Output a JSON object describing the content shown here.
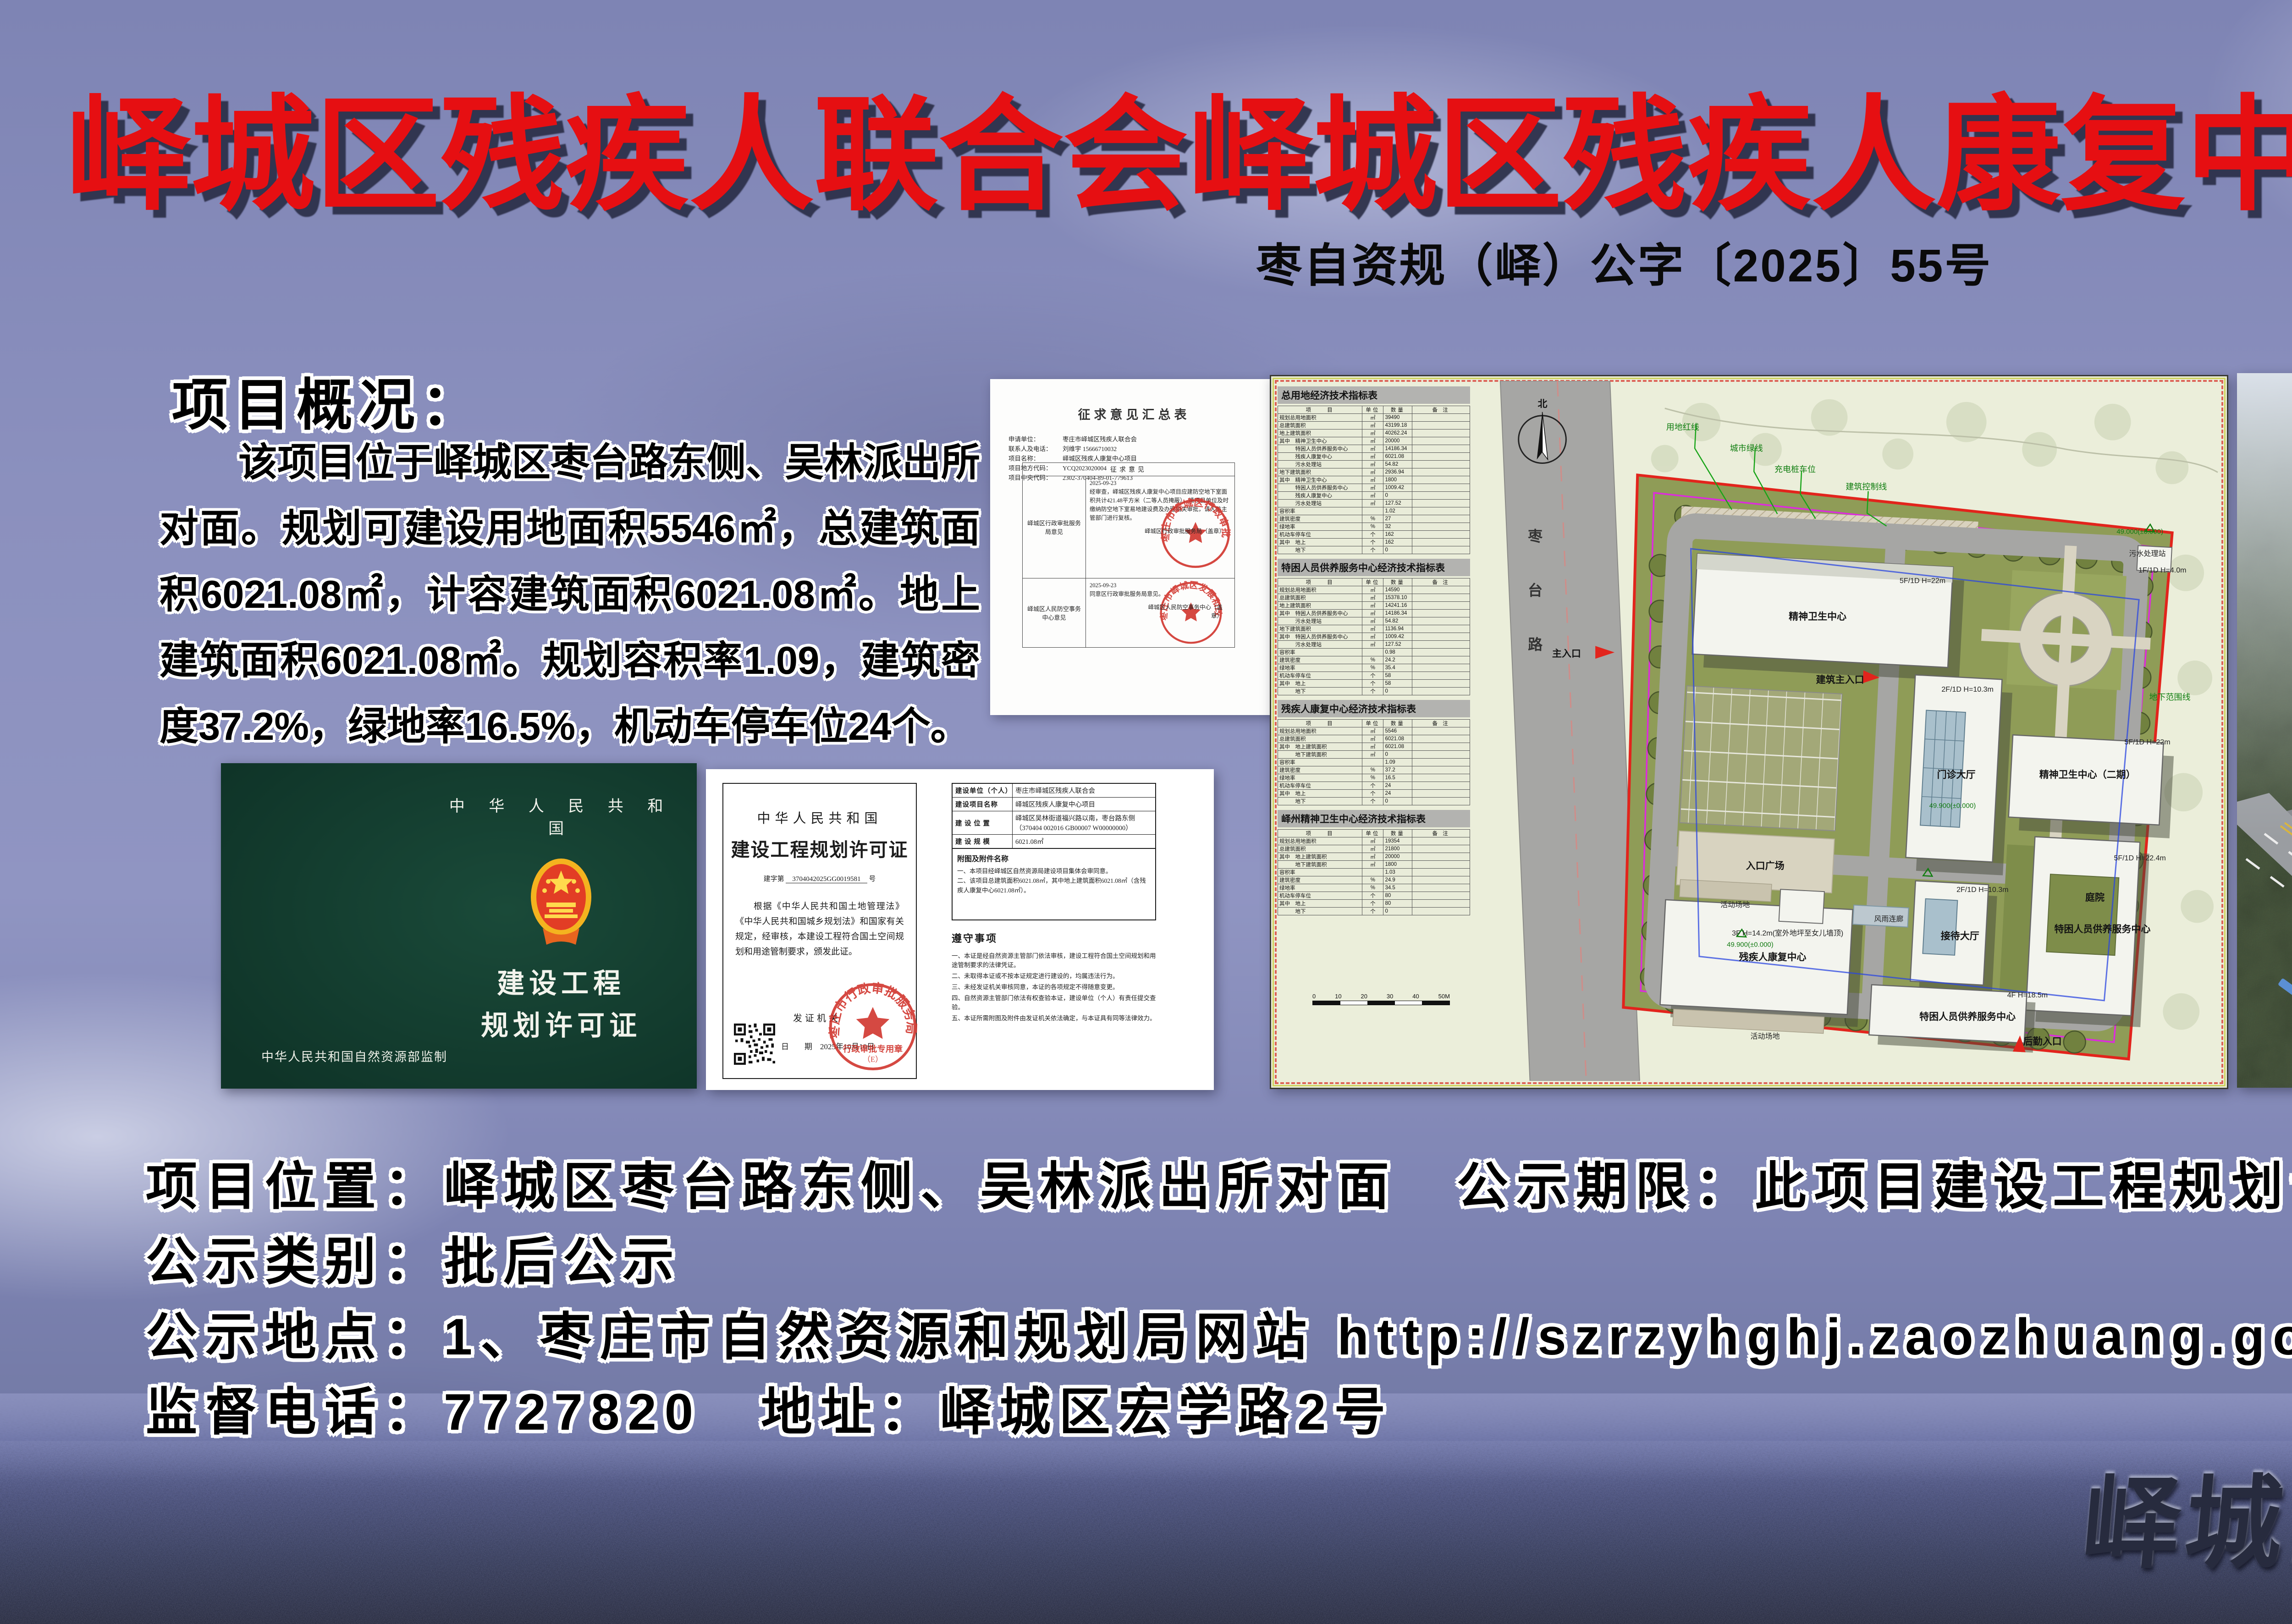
{
  "poster": {
    "title": "峄城区残疾人联合会峄城区残疾人康复中心项目批后公示",
    "doc_number": "枣自资规（峄）公字〔2025〕55号",
    "overview": {
      "heading": "项目概况：",
      "body": "该项目位于峄城区枣台路东侧、吴林派出所对面。规划可建设用地面积5546㎡，总建筑面积6021.08㎡，计容建筑面积6021.08㎡。地上建筑面积6021.08㎡。规划容积率1.09，建筑密度37.2%，绿地率16.5%，机动车停车位24个。"
    },
    "footer": {
      "line1": {
        "label1": "项目位置：",
        "value1": "峄城区枣台路东侧、吴林派出所对面",
        "label2": "公示期限：",
        "value2": "此项目建设工程规划许可证生效日至竣工验收合格日"
      },
      "line2": {
        "label1": "公示类别：",
        "value1": "批后公示"
      },
      "line3": {
        "label1": "公示地点：",
        "value1": "1、枣庄市自然资源和规划局网站 http://szrzyhghj.zaozhuang.gov.cn/",
        "value2": "2、建设项目现场"
      },
      "line4": {
        "label1": "监督电话：",
        "value1": "7727820",
        "label2": "地址：",
        "value2": "峄城区宏学路2号"
      }
    },
    "watermark": "峄城区自然资源局监制"
  },
  "opinion_doc": {
    "title": "征求意见汇总表",
    "fields": [
      {
        "label": "申请单位：",
        "value": "枣庄市峄城区残疾人联合会"
      },
      {
        "label": "联系人及电话：",
        "value": "刘维宇  15666710032"
      },
      {
        "label": "项目名称：",
        "value": "峄城区残疾人康复中心项目"
      },
      {
        "label": "项目地方代码：",
        "value": "YCQ2023020004"
      },
      {
        "label": "项目中央代码：",
        "value": "2302-370404-89-01-779613"
      }
    ],
    "table_header": "征求意见",
    "row1": {
      "org": "峄城区行政审批服务局意见",
      "date": "2025-09-23",
      "text": "经审查，峄城区残疾人康复中心项目应建防空地下室面积共计421.48平方米（二等人员掩蔽），请项目单位及时缴纳防空地下室易地建设费及办理相关审批，请人防主管部门进行复核。",
      "sign": "峄城区行政审批服务局（盖章）",
      "stamp_arc": "枣庄市峄城区行政审批服务局"
    },
    "row2": {
      "org": "峄城区人民防空事务中心意见",
      "date": "2025-09-23",
      "text": "同意区行政审批服务局意见。",
      "sign": "峄城区人民防空事务中心（盖章）",
      "stamp_arc": "枣庄市峄城区发展和改革局"
    }
  },
  "green_cert": {
    "country": "中 华 人 民 共 和 国",
    "title_line1": "建设工程",
    "title_line2": "规划许可证",
    "footer": "中华人民共和国自然资源部监制"
  },
  "white_cert": {
    "left": {
      "country": "中华人民共和国",
      "title": "建设工程规划许可证",
      "number_prefix": "建字第",
      "number": "3704042025GG0019581",
      "number_suffix": "号",
      "body": "根据《中华人民共和国土地管理法》《中华人民共和国城乡规划法》和国家有关规定，经审核，本建设工程符合国土空间规划和用途管制要求，颁发此证。",
      "issuer_label": "发证机关",
      "date_label": "日　　期",
      "date": "2025年10月10日",
      "stamp_arc": "枣庄市行政审批服务局",
      "stamp_line": "行政审批专用章",
      "stamp_sub": "（E）"
    },
    "right": {
      "rows": [
        {
          "label": "建设单位（个人）",
          "value": "枣庄市峄城区残疾人联合会"
        },
        {
          "label": "建设项目名称",
          "value": "峄城区残疾人康复中心项目"
        },
        {
          "label": "建 设 位 置",
          "value": "峄城区吴林街道福兴路以南，枣台路东侧（370404 002016 GB00007 W00000000）"
        },
        {
          "label": "建 设 规 模",
          "value": "6021.08㎡"
        }
      ],
      "attach_heading": "附图及附件名称",
      "attach_items": [
        {
          "text": "一、本项目经峄城区自然资源局建设项目集体会审同意。"
        },
        {
          "text": "二、该项目总建筑面积6021.08㎡，其中地上建筑面积6021.08㎡（含残疾人康复中心6021.08㎡）。"
        }
      ],
      "rules_heading": "遵守事项",
      "rules": [
        {
          "text": "一、本证是经自然资源主管部门依法审核，建设工程符合国土空间规划和用途管制要求的法律凭证。"
        },
        {
          "text": "二、未取得本证或不按本证规定进行建设的，均属违法行为。"
        },
        {
          "text": "三、未经发证机关审核同意，本证的各项规定不得随意变更。"
        },
        {
          "text": "四、自然资源主管部门依法有权查验本证，建设单位（个人）有责任提交查验。"
        },
        {
          "text": "五、本证所需附图及附件由发证机关依法确定，与本证具有同等法律效力。"
        }
      ]
    }
  },
  "site_plan": {
    "cols": {
      "item": "项　　目",
      "unit": "单位",
      "qty": "数量",
      "note": "备 注"
    },
    "tables": [
      {
        "title": "总用地经济技术指标表",
        "rows": [
          {
            "label": "规划总用地面积",
            "unit": "㎡",
            "value": "39490"
          },
          {
            "label": "总建筑面积",
            "unit": "㎡",
            "value": "43199.18"
          },
          {
            "label": "地上建筑面积",
            "unit": "㎡",
            "value": "40262.24"
          },
          {
            "label": "其中　精神卫生中心",
            "unit": "㎡",
            "value": "20000"
          },
          {
            "label": "　　　特困人员供养服务中心",
            "unit": "㎡",
            "value": "14186.34"
          },
          {
            "label": "　　　残疾人康复中心",
            "unit": "㎡",
            "value": "6021.08"
          },
          {
            "label": "　　　污水处理站",
            "unit": "㎡",
            "value": "54.82"
          },
          {
            "label": "地下建筑面积",
            "unit": "㎡",
            "value": "2936.94"
          },
          {
            "label": "其中　精神卫生中心",
            "unit": "㎡",
            "value": "1800"
          },
          {
            "label": "　　　特困人员供养服务中心",
            "unit": "㎡",
            "value": "1009.42"
          },
          {
            "label": "　　　残疾人康复中心",
            "unit": "㎡",
            "value": "0"
          },
          {
            "label": "　　　污水处理站",
            "unit": "㎡",
            "value": "127.52"
          },
          {
            "label": "容积率",
            "unit": "",
            "value": "1.02"
          },
          {
            "label": "建筑密度",
            "unit": "%",
            "value": "27"
          },
          {
            "label": "绿地率",
            "unit": "%",
            "value": "32"
          },
          {
            "label": "机动车停车位",
            "unit": "个",
            "value": "162"
          },
          {
            "label": "其中　地上",
            "unit": "个",
            "value": "162"
          },
          {
            "label": "　　　地下",
            "unit": "个",
            "value": "0"
          }
        ]
      },
      {
        "title": "特困人员供养服务中心经济技术指标表",
        "rows": [
          {
            "label": "规划总用地面积",
            "unit": "㎡",
            "value": "14590"
          },
          {
            "label": "总建筑面积",
            "unit": "㎡",
            "value": "15378.10"
          },
          {
            "label": "地上建筑面积",
            "unit": "㎡",
            "value": "14241.16"
          },
          {
            "label": "其中　特困人员供养服务中心",
            "unit": "㎡",
            "value": "14186.34"
          },
          {
            "label": "　　　污水处理站",
            "unit": "㎡",
            "value": "54.82"
          },
          {
            "label": "地下建筑面积",
            "unit": "㎡",
            "value": "1136.94"
          },
          {
            "label": "其中　特困人员供养服务中心",
            "unit": "㎡",
            "value": "1009.42"
          },
          {
            "label": "　　　污水处理站",
            "unit": "㎡",
            "value": "127.52"
          },
          {
            "label": "容积率",
            "unit": "",
            "value": "0.98"
          },
          {
            "label": "建筑密度",
            "unit": "%",
            "value": "24.2"
          },
          {
            "label": "绿地率",
            "unit": "%",
            "value": "35.4"
          },
          {
            "label": "机动车停车位",
            "unit": "个",
            "value": "58"
          },
          {
            "label": "其中　地上",
            "unit": "个",
            "value": "58"
          },
          {
            "label": "　　　地下",
            "unit": "个",
            "value": "0"
          }
        ]
      },
      {
        "title": "残疾人康复中心经济技术指标表",
        "rows": [
          {
            "label": "规划总用地面积",
            "unit": "㎡",
            "value": "5546"
          },
          {
            "label": "总建筑面积",
            "unit": "㎡",
            "value": "6021.08"
          },
          {
            "label": "其中　地上建筑面积",
            "unit": "㎡",
            "value": "6021.08"
          },
          {
            "label": "　　　地下建筑面积",
            "unit": "㎡",
            "value": "0"
          },
          {
            "label": "容积率",
            "unit": "",
            "value": "1.09"
          },
          {
            "label": "建筑密度",
            "unit": "%",
            "value": "37.2"
          },
          {
            "label": "绿地率",
            "unit": "%",
            "value": "16.5"
          },
          {
            "label": "机动车停车位",
            "unit": "个",
            "value": "24"
          },
          {
            "label": "其中　地上",
            "unit": "个",
            "value": "24"
          },
          {
            "label": "　　　地下",
            "unit": "个",
            "value": "0"
          }
        ]
      },
      {
        "title": "峄州精神卫生中心经济技术指标表",
        "rows": [
          {
            "label": "规划总用地面积",
            "unit": "㎡",
            "value": "19354"
          },
          {
            "label": "总建筑面积",
            "unit": "㎡",
            "value": "21800"
          },
          {
            "label": "其中　地上建筑面积",
            "unit": "㎡",
            "value": "20000"
          },
          {
            "label": "　　　地下建筑面积",
            "unit": "㎡",
            "value": "1800"
          },
          {
            "label": "容积率",
            "unit": "",
            "value": "1.03"
          },
          {
            "label": "建筑密度",
            "unit": "%",
            "value": "24.9"
          },
          {
            "label": "绿地率",
            "unit": "%",
            "value": "34.5"
          },
          {
            "label": "机动车停车位",
            "unit": "个",
            "value": "80"
          },
          {
            "label": "其中　地上",
            "unit": "个",
            "value": "80"
          },
          {
            "label": "　　　地下",
            "unit": "个",
            "value": "0"
          }
        ]
      }
    ],
    "scale_ticks": [
      "0",
      "10",
      "20",
      "30",
      "40",
      "50M"
    ],
    "labels": {
      "north": "北",
      "road": "枣台路",
      "main_entrance": "主入口",
      "mental_center": "精神卫生中心",
      "mental_spec": "5F/1D H=22m",
      "outpatient": "门诊大厅",
      "outpatient_spec": "2F/1D H=10.3m",
      "mental2": "精神卫生中心（二期）",
      "mental2_spec": "5F/1D H=22m",
      "plaza": "入口广场",
      "rehab": "残疾人康复中心",
      "rehab_spec": "3F H=14.2m(室外地坪至女儿墙顶)",
      "activity": "活动场地",
      "corridor": "风雨连廊",
      "reception": "接待大厅",
      "reception_spec": "2F/1D H=10.3m",
      "tekun": "特困人员供养服务中心",
      "tekun_spec": "4F H=18.5m",
      "tekun2": "特困人员供养服务中心",
      "tekun2_spec": "5F/1D H=22.4m",
      "courtyard": "庭院",
      "sewage": "污水处理站",
      "sewage_spec": "1F/1D H=4.0m",
      "elev": "49.900(±0.000)",
      "elev2": "49.900(±0.000)",
      "elev3": "49.000(±0.000)",
      "entrance": "建筑主入口",
      "service_entrance": "后勤入口",
      "legend_red": "用地红线",
      "legend_green": "城市绿线",
      "legend_charge": "充电桩车位",
      "legend_ctrl": "建筑控制线",
      "legend_underground": "地下范围线"
    }
  }
}
